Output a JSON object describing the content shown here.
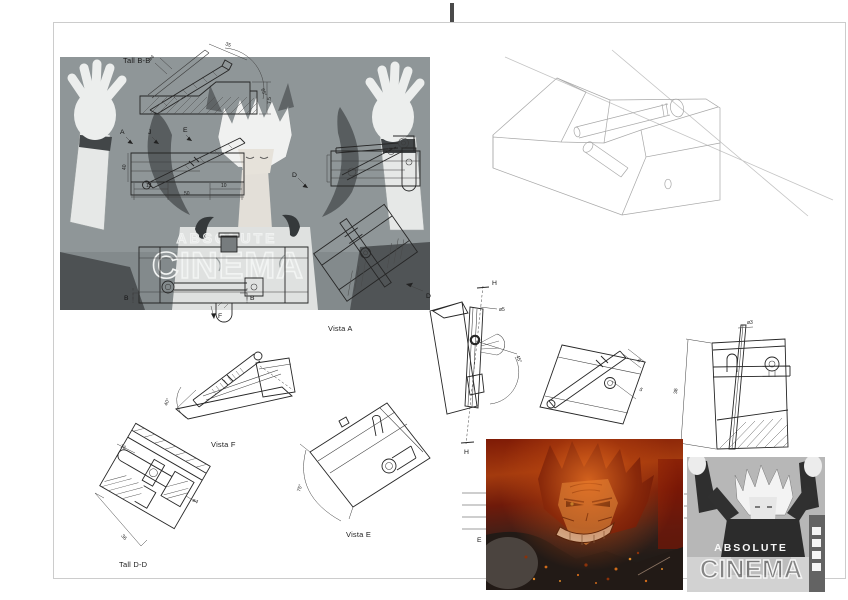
{
  "page": {
    "sheet_labels": {
      "section_bb": "Tall B-B",
      "view_a": "Vista A",
      "view_f": "Vista F",
      "view_e": "Vista E",
      "section_dd": "Tall D-D"
    },
    "markers": {
      "a": "A",
      "j": "J",
      "e_top": "E",
      "d_on_image": "D",
      "d_leader": "D",
      "f": "F",
      "b_left": "B",
      "b_right": "B",
      "h_top": "H",
      "h_bottom": "H",
      "e_mid": "E"
    },
    "dimensions": {
      "rod_dia": "ø4",
      "len_35": "35",
      "ang_65": "65°",
      "len_7_5": "7.5",
      "len_40": "40",
      "len_13": "13",
      "len_10": "10",
      "len_50": "50",
      "pin_dia": "ø5",
      "ang_45": "45°",
      "len_8": "8",
      "len_5": "5",
      "hole_dia": "ø3",
      "len_38": "38",
      "len_16": "16",
      "screw_dia": "ø4",
      "len_36": "36",
      "ang_40": "40°",
      "ang_75": "75°"
    },
    "meme_top": {
      "line1": "ABSOLUTE",
      "line2": "CINEMA"
    },
    "meme_bottom": {
      "line1": "ABSOLUTE",
      "line2": "CINEMA"
    },
    "colors": {
      "frame": "#cccccc",
      "drawing_line": "#262626",
      "iso_line": "#a8a8a8",
      "meme_gray": "#90979a",
      "sukuna_red": "#a33a0e",
      "cinema_gray": "#b7b7b7"
    }
  }
}
